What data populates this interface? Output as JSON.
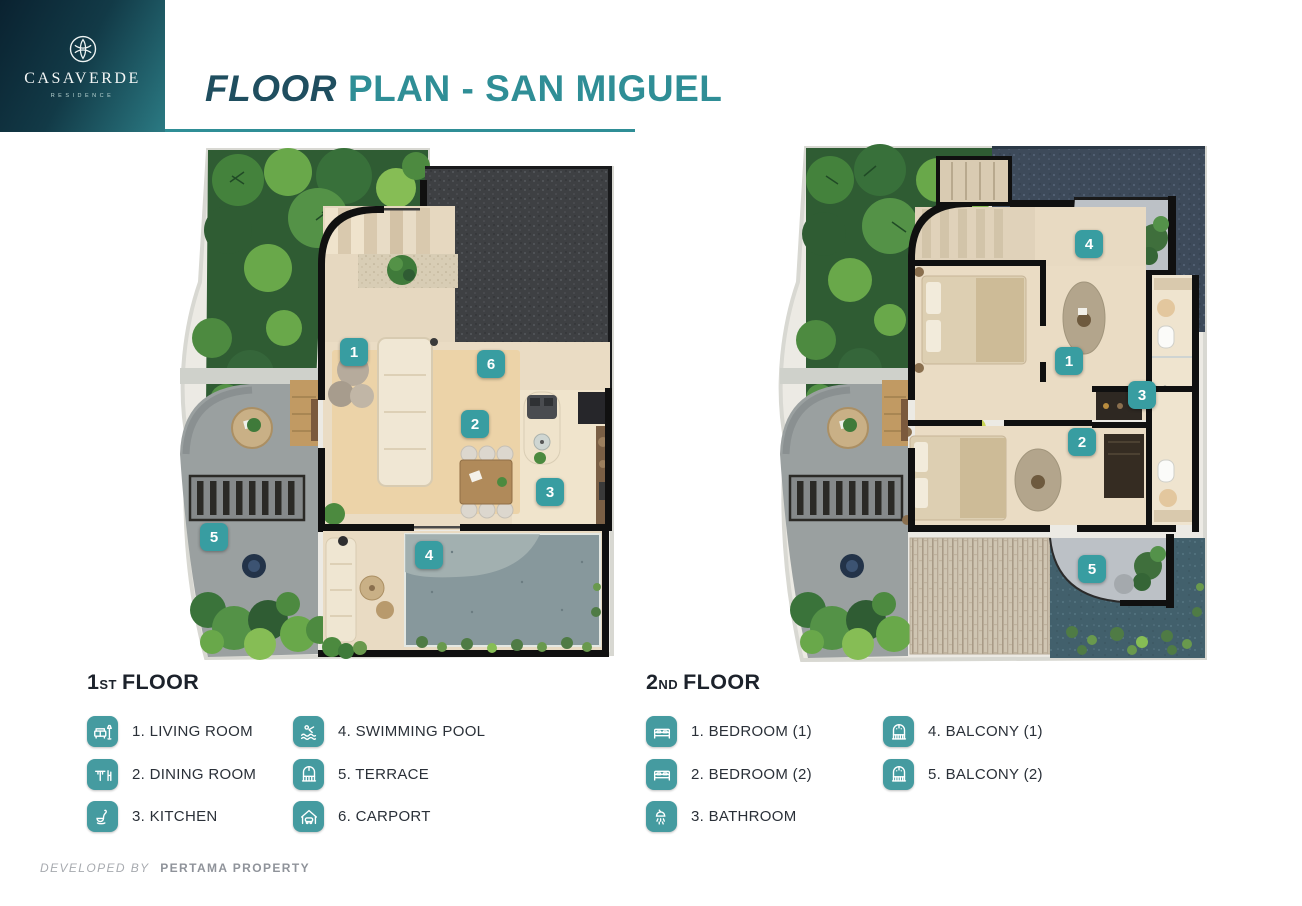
{
  "header": {
    "logo": {
      "brand": "CASAVERDE",
      "tagline": "RESIDENCE"
    },
    "title": {
      "emphasis": "FLOOR",
      "rest": "PLAN - SAN MIGUEL"
    }
  },
  "plans": {
    "first": {
      "badges": [
        {
          "label": "1"
        },
        {
          "label": "2"
        },
        {
          "label": "3"
        },
        {
          "label": "4"
        },
        {
          "label": "5"
        },
        {
          "label": "6"
        }
      ]
    },
    "second": {
      "badges": [
        {
          "label": "1"
        },
        {
          "label": "2"
        },
        {
          "label": "3"
        },
        {
          "label": "4"
        },
        {
          "label": "5"
        }
      ]
    }
  },
  "legends": {
    "first": {
      "heading": {
        "number": "1",
        "suffix": "ST",
        "word": "FLOOR"
      },
      "columns": [
        [
          {
            "icon": "sofa-icon",
            "label": "1. LIVING ROOM"
          },
          {
            "icon": "dining-table-icon",
            "label": "2. DINING ROOM"
          },
          {
            "icon": "kitchen-ladle-icon",
            "label": "3. KITCHEN"
          }
        ],
        [
          {
            "icon": "swimmer-icon",
            "label": "4. SWIMMING POOL"
          },
          {
            "icon": "arch-window-icon",
            "label": "5. TERRACE"
          },
          {
            "icon": "carport-icon",
            "label": "6. CARPORT"
          }
        ]
      ]
    },
    "second": {
      "heading": {
        "number": "2",
        "suffix": "ND",
        "word": "FLOOR"
      },
      "columns": [
        [
          {
            "icon": "bed-icon",
            "label": "1. BEDROOM (1)"
          },
          {
            "icon": "bed-icon",
            "label": "2. BEDROOM (2)"
          },
          {
            "icon": "shower-icon",
            "label": "3. BATHROOM"
          }
        ],
        [
          {
            "icon": "balcony-arch-icon",
            "label": "4. BALCONY (1)"
          },
          {
            "icon": "balcony-arch-icon",
            "label": "5. BALCONY (2)"
          }
        ]
      ]
    }
  },
  "footer": {
    "prefix": "DEVELOPED BY",
    "company": "PERTAMA PROPERTY"
  },
  "theme": {
    "badge_teal": "#389da1",
    "legend_tile_teal": "#459ba0",
    "title_dark": "#1f4e5f",
    "title_teal": "#2f8e96",
    "divider_teal": "#2f8e96",
    "logo_gradient_start": "#0a2230",
    "logo_gradient_end": "#2b7a83",
    "text_dark": "#2a3038",
    "footer_gray": "#8f939a"
  }
}
